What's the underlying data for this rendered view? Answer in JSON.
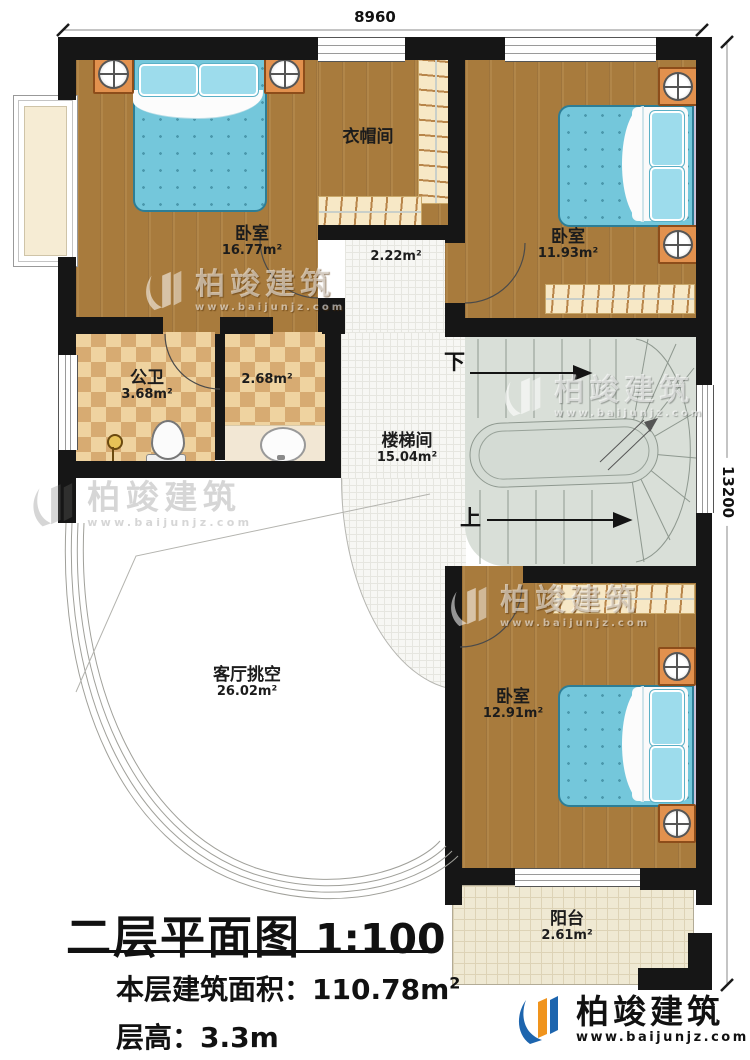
{
  "dimensions": {
    "width_label": "8960",
    "height_label": "13200"
  },
  "rooms": [
    {
      "name": "卧室",
      "area": "16.77m²"
    },
    {
      "name": "衣帽间",
      "area": ""
    },
    {
      "name": "",
      "area": "2.22m²"
    },
    {
      "name": "卧室",
      "area": "11.93m²"
    },
    {
      "name": "公卫",
      "area": "3.68m²"
    },
    {
      "name": "",
      "area": "2.68m²"
    },
    {
      "name": "楼梯间",
      "area": "15.04m²"
    },
    {
      "name": "客厅挑空",
      "area": "26.02m²"
    },
    {
      "name": "卧室",
      "area": "12.91m²"
    },
    {
      "name": "阳台",
      "area": "2.61m²"
    }
  ],
  "stairs": {
    "down": "下",
    "up": "上"
  },
  "title_block": {
    "title": "二层平面图",
    "scale": "1:100",
    "floor_area_label": "本层建筑面积：",
    "floor_area_value": "110.78m",
    "floor_area_sup": "2",
    "floor_height_label": "层高：",
    "floor_height_value": "3.3m"
  },
  "branding": {
    "name": "柏竣建筑",
    "site": "www.baijunjz.com"
  },
  "watermark": {
    "name": "柏竣建筑",
    "site": "www.baijunjz.com"
  },
  "colors": {
    "wall": "#161616",
    "wood": "#a87b3d",
    "tile_light": "#efd3a0",
    "tile_dark": "#d7ab72",
    "bed": "#74c7db",
    "stair": "#d9dfd8",
    "balcony": "#efe9d3",
    "furniture_orange": "#e2914e",
    "logo_blue": "#1d65ae",
    "logo_orange": "#f0941d"
  }
}
